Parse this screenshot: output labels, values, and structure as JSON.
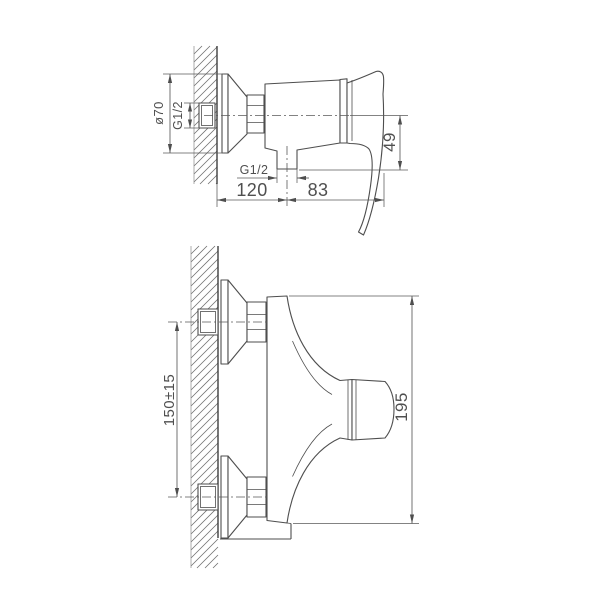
{
  "drawing": {
    "subject": "wall-mounted single-lever shower mixer installation drawing",
    "background": "#ffffff",
    "line_color": "#4e4e4e",
    "views": [
      {
        "id": "side",
        "name": "side view with wall section"
      },
      {
        "id": "front",
        "name": "front view with wall section"
      }
    ]
  },
  "dimensions": {
    "escutcheon_diameter": "ø70",
    "inlet_thread": "G1/2",
    "outlet_thread": "G1/2",
    "outlet_drop": "49",
    "wall_to_outlet": "120",
    "outlet_to_handle": "83",
    "inlet_centers": "150±15",
    "overall_height": "195"
  }
}
